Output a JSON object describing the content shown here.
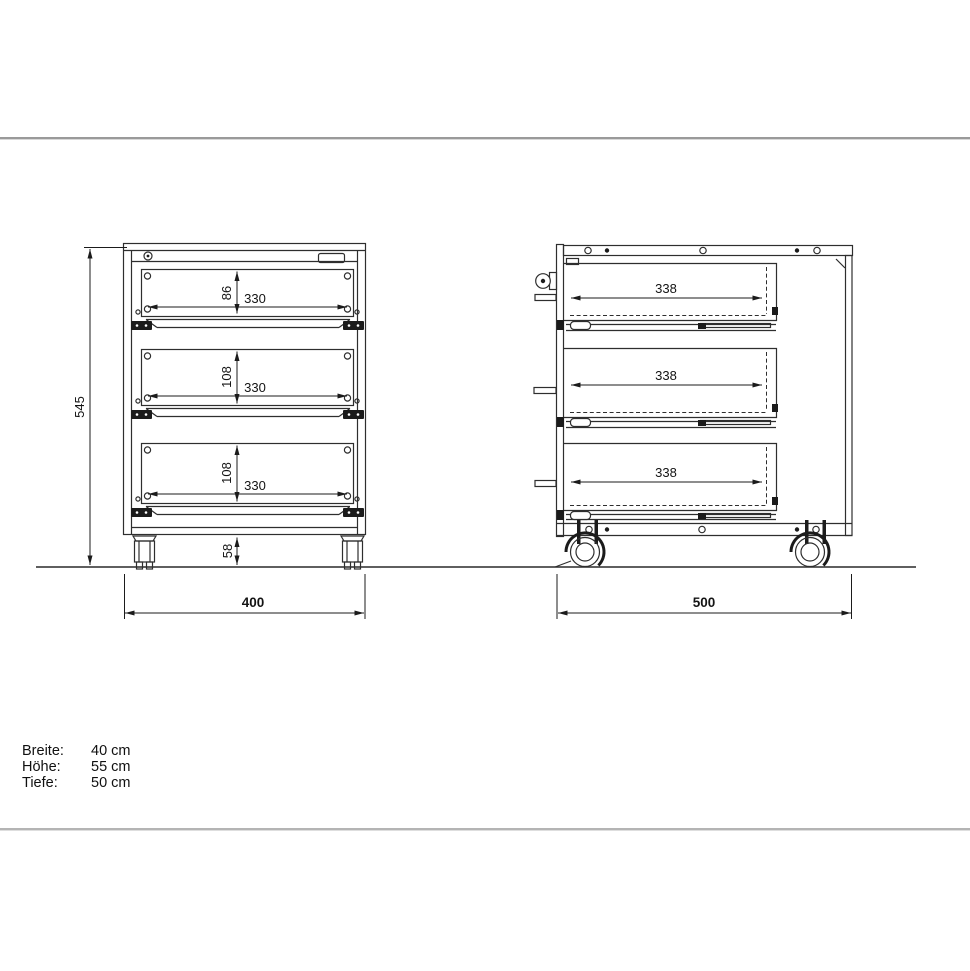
{
  "front_view": {
    "total_height_mm": "545",
    "base_height_mm": "58",
    "total_width_mm": "400",
    "drawers": [
      {
        "front_height_mm": "86",
        "front_width_mm": "330"
      },
      {
        "front_height_mm": "108",
        "front_width_mm": "330"
      },
      {
        "front_height_mm": "108",
        "front_width_mm": "330"
      }
    ]
  },
  "side_view": {
    "total_depth_mm": "500",
    "drawers": [
      {
        "depth_mm": "338"
      },
      {
        "depth_mm": "338"
      },
      {
        "depth_mm": "338"
      }
    ]
  },
  "specs": {
    "rows": [
      {
        "label": "Breite:",
        "value": "40 cm"
      },
      {
        "label": "Höhe:",
        "value": "55 cm"
      },
      {
        "label": "Tiefe:",
        "value": "50 cm"
      }
    ]
  },
  "colors": {
    "line": "#2e2e2e",
    "divider_top": "#9a9a9a",
    "divider_bottom": "#b4b4b4"
  }
}
